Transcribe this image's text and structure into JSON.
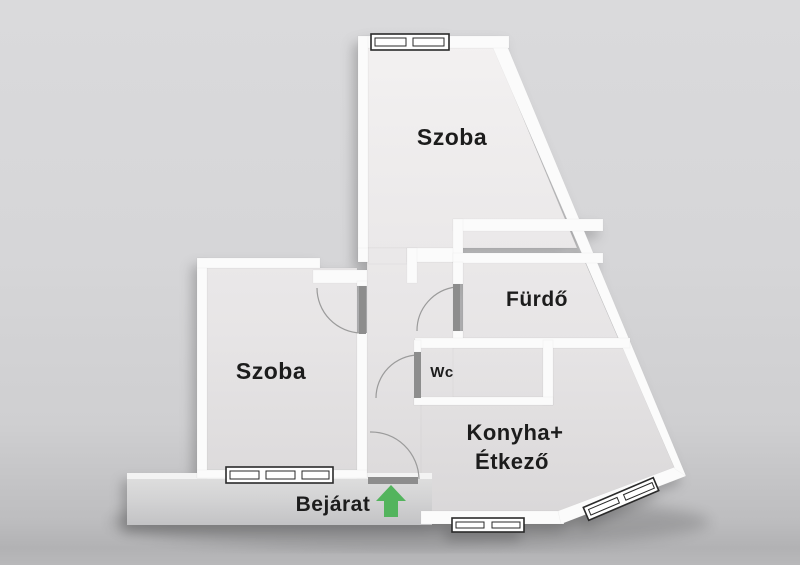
{
  "rooms": {
    "szoba_top": "Szoba",
    "furdo": "Fürdő",
    "szoba_left": "Szoba",
    "wc": "Wc",
    "konyha_line1": "Konyha+",
    "konyha_line2": "Étkező"
  },
  "entrance": {
    "label": "Bejárat",
    "direction": "up"
  },
  "colors": {
    "wall": "#fbfbfb",
    "floor_light": "#f3f1f1",
    "floor_dark": "#d9d7d8",
    "door_leaf": "#8d8d8d",
    "arrow_green": "#53b45d",
    "label_text": "#1c1c1c"
  }
}
